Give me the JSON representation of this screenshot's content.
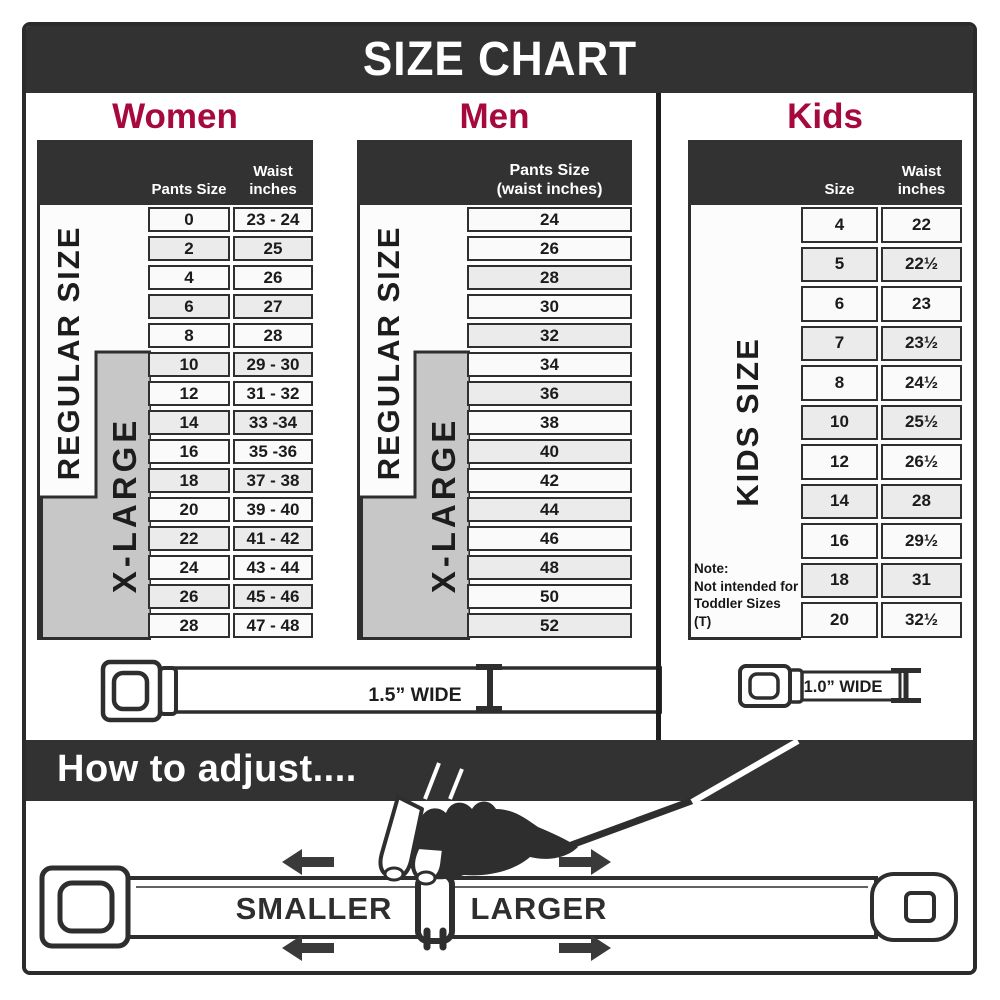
{
  "title": "SIZE CHART",
  "colors": {
    "accent": "#A6093D",
    "band_dark": "#323232",
    "panel_gray": "#C7C7C7",
    "row_alt": "#EBEBEB",
    "row_base": "#FAFAFA"
  },
  "sections": {
    "women": {
      "title": "Women",
      "col1_header": "Pants Size",
      "col2_line1": "Waist",
      "col2_line2": "inches",
      "regular_label": "REGULAR SIZE",
      "xlarge_label": "X-LARGE",
      "rows": [
        {
          "size": "0",
          "waist": "23 - 24",
          "shaded": false
        },
        {
          "size": "2",
          "waist": "25",
          "shaded": true
        },
        {
          "size": "4",
          "waist": "26",
          "shaded": false
        },
        {
          "size": "6",
          "waist": "27",
          "shaded": true
        },
        {
          "size": "8",
          "waist": "28",
          "shaded": false
        },
        {
          "size": "10",
          "waist": "29 - 30",
          "shaded": true
        },
        {
          "size": "12",
          "waist": "31 - 32",
          "shaded": false
        },
        {
          "size": "14",
          "waist": "33 -34",
          "shaded": true
        },
        {
          "size": "16",
          "waist": "35 -36",
          "shaded": false
        },
        {
          "size": "18",
          "waist": "37 - 38",
          "shaded": true
        },
        {
          "size": "20",
          "waist": "39 - 40",
          "shaded": false
        },
        {
          "size": "22",
          "waist": "41 - 42",
          "shaded": true
        },
        {
          "size": "24",
          "waist": "43 - 44",
          "shaded": false
        },
        {
          "size": "26",
          "waist": "45 - 46",
          "shaded": true
        },
        {
          "size": "28",
          "waist": "47 - 48",
          "shaded": false
        }
      ]
    },
    "men": {
      "title": "Men",
      "col_line1": "Pants Size",
      "col_line2": "(waist inches)",
      "regular_label": "REGULAR SIZE",
      "xlarge_label": "X-LARGE",
      "rows": [
        {
          "size": "24",
          "shaded": false
        },
        {
          "size": "26",
          "shaded": false
        },
        {
          "size": "28",
          "shaded": true
        },
        {
          "size": "30",
          "shaded": false
        },
        {
          "size": "32",
          "shaded": true
        },
        {
          "size": "34",
          "shaded": false
        },
        {
          "size": "36",
          "shaded": true
        },
        {
          "size": "38",
          "shaded": false
        },
        {
          "size": "40",
          "shaded": true
        },
        {
          "size": "42",
          "shaded": false
        },
        {
          "size": "44",
          "shaded": true
        },
        {
          "size": "46",
          "shaded": false
        },
        {
          "size": "48",
          "shaded": true
        },
        {
          "size": "50",
          "shaded": false
        },
        {
          "size": "52",
          "shaded": true
        }
      ]
    },
    "kids": {
      "title": "Kids",
      "col1_header": "Size",
      "col2_line1": "Waist",
      "col2_line2": "inches",
      "side_label": "KIDS SIZE",
      "note_line1": "Note:",
      "note_line2": "Not intended for",
      "note_line3": "Toddler Sizes (T)",
      "rows": [
        {
          "size": "4",
          "waist": "22",
          "shaded": false
        },
        {
          "size": "5",
          "waist": "22½",
          "shaded": true
        },
        {
          "size": "6",
          "waist": "23",
          "shaded": false
        },
        {
          "size": "7",
          "waist": "23½",
          "shaded": true
        },
        {
          "size": "8",
          "waist": "24½",
          "shaded": false
        },
        {
          "size": "10",
          "waist": "25½",
          "shaded": true
        },
        {
          "size": "12",
          "waist": "26½",
          "shaded": false
        },
        {
          "size": "14",
          "waist": "28",
          "shaded": true
        },
        {
          "size": "16",
          "waist": "29½",
          "shaded": false
        },
        {
          "size": "18",
          "waist": "31",
          "shaded": true
        },
        {
          "size": "20",
          "waist": "32½",
          "shaded": false
        }
      ]
    }
  },
  "belts": {
    "adult_width_label": "1.5” WIDE",
    "kids_width_label": "1.0” WIDE"
  },
  "adjust": {
    "heading": "How to adjust....",
    "smaller_label": "SMALLER",
    "larger_label": "LARGER"
  }
}
